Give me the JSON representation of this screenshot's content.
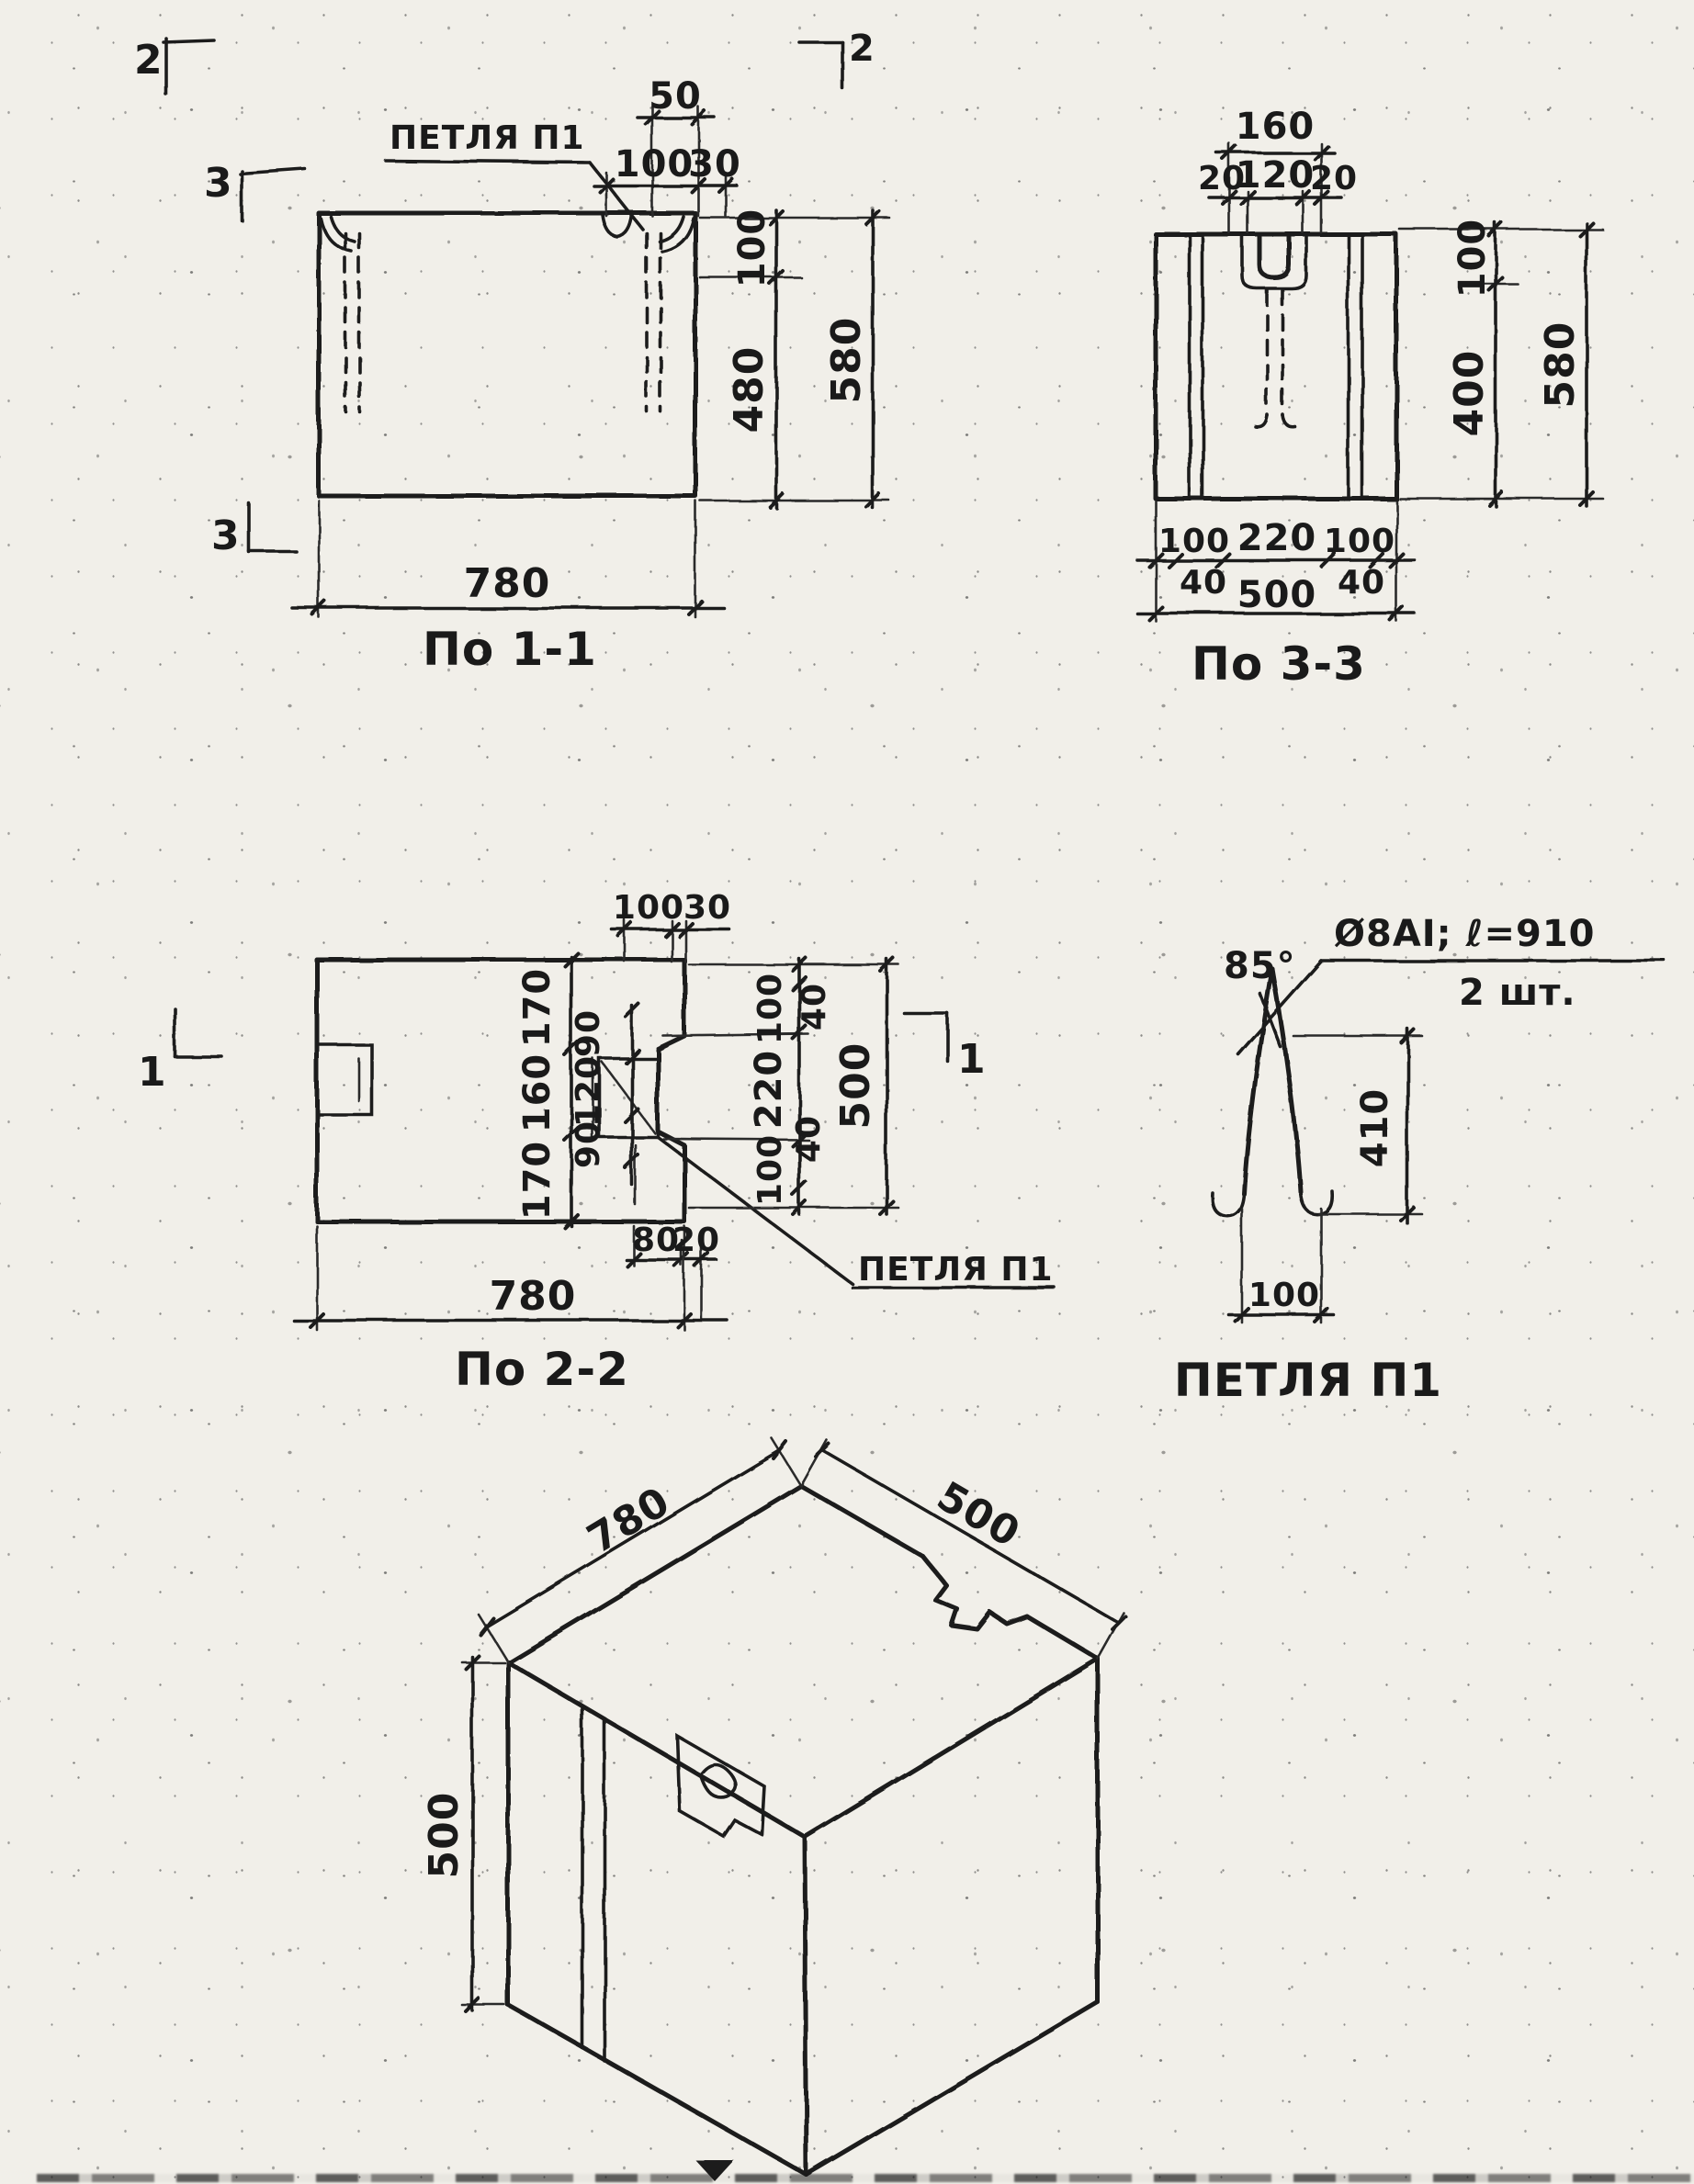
{
  "s11": {
    "label": "По 1-1",
    "petlya": "ПЕТЛЯ П1",
    "m2": "2",
    "m2r": "2",
    "m3a": "3",
    "m3b": "3",
    "d50": "50",
    "d100t": "100",
    "d30": "30",
    "d100r": "100",
    "d480": "480",
    "d580": "580",
    "d780": "780"
  },
  "s33": {
    "label": "По 3-3",
    "d160": "160",
    "d20l": "20",
    "d120": "120",
    "d20r": "20",
    "d100r": "100",
    "d400": "400",
    "d580": "580",
    "db100l": "100",
    "db220": "220",
    "db100r": "100",
    "db40l": "40",
    "db40r": "40",
    "db500": "500"
  },
  "s22": {
    "label": "По 2-2",
    "petlya": "ПЕТЛЯ П1",
    "m1l": "1",
    "m1r": "1",
    "d100t": "100",
    "d30t": "30",
    "dv170a": "170",
    "dv160": "160",
    "dv170b": "170",
    "di90a": "90",
    "di120": "120",
    "di90b": "90",
    "dr100a": "100",
    "dr220": "220",
    "dr100b": "100",
    "dr40a": "40",
    "dr40b": "40",
    "dr500": "500",
    "d80": "80",
    "d20": "20",
    "d780": "780"
  },
  "p1": {
    "label": "ПЕТЛЯ П1",
    "angle": "85°",
    "spec": "Ø8АI; ℓ=910",
    "qty": "2 шт.",
    "d410": "410",
    "d100": "100"
  },
  "iso": {
    "d780": "780",
    "d500w": "500",
    "d500h": "500"
  }
}
